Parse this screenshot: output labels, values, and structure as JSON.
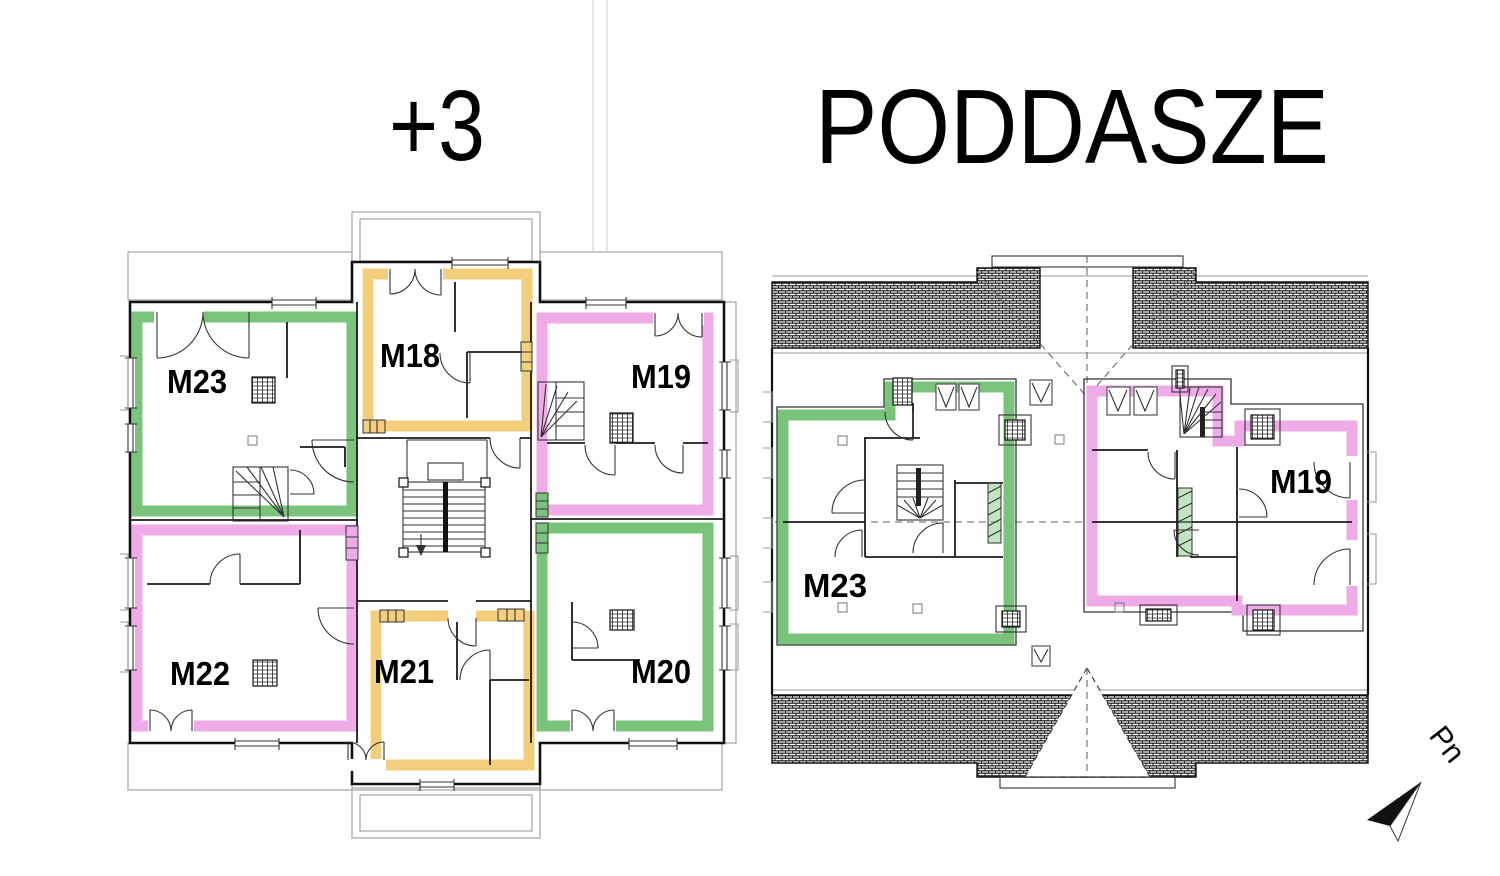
{
  "left_plan": {
    "title": "+3",
    "apartments": [
      {
        "id": "M23",
        "color_name": "green"
      },
      {
        "id": "M18",
        "color_name": "orange"
      },
      {
        "id": "M19",
        "color_name": "pink"
      },
      {
        "id": "M22",
        "color_name": "pink"
      },
      {
        "id": "M21",
        "color_name": "orange"
      },
      {
        "id": "M20",
        "color_name": "green"
      }
    ]
  },
  "right_plan": {
    "title": "PODDASZE",
    "apartments": [
      {
        "id": "M23",
        "color_name": "green"
      },
      {
        "id": "M19",
        "color_name": "pink"
      }
    ]
  },
  "compass": {
    "label": "Pn"
  },
  "colors": {
    "green": "#79c37a",
    "orange": "#f3cf7d",
    "pink": "#efaae8"
  }
}
